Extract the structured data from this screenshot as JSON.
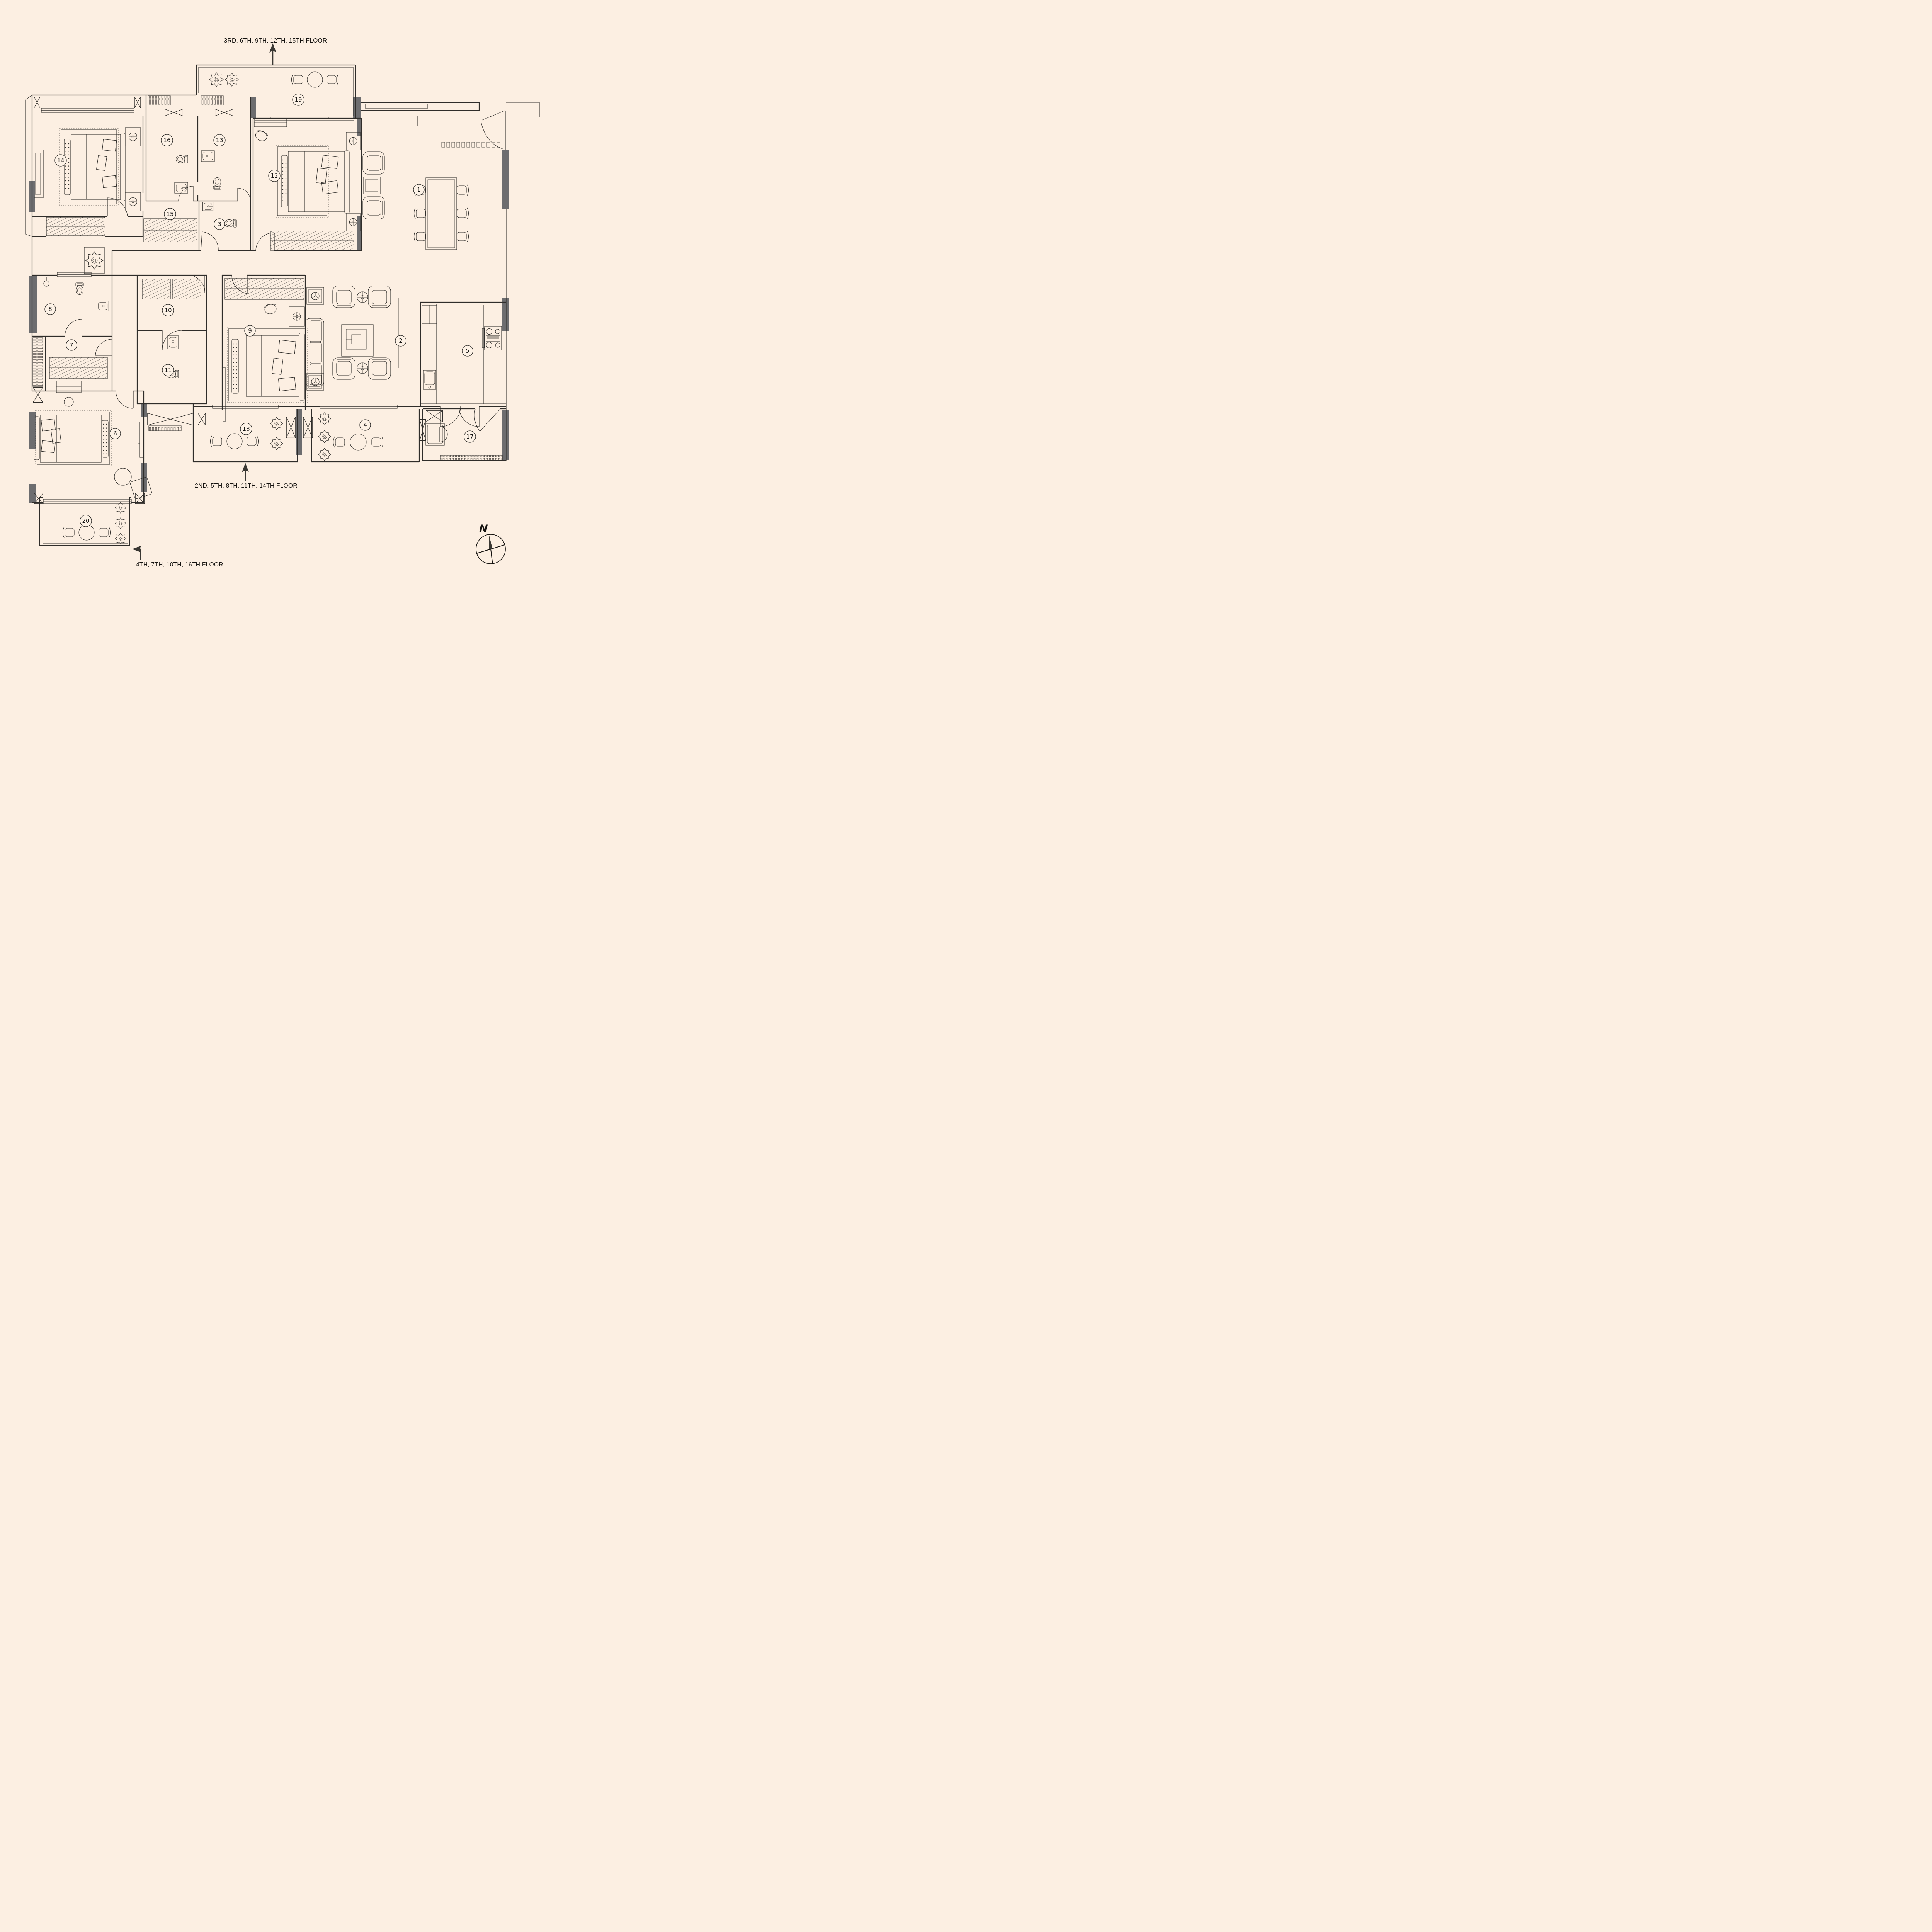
{
  "colors": {
    "background": "#fcefe2",
    "line": "#2f2d2a",
    "column_fill": "#6d6d6f"
  },
  "floor_labels": {
    "top": "3RD, 6TH, 9TH, 12TH, 15TH  FLOOR",
    "middle": "2ND, 5TH, 8TH, 11TH, 14TH  FLOOR",
    "bottom": "4TH, 7TH, 10TH, 16TH  FLOOR"
  },
  "compass": {
    "north": "N"
  },
  "rooms": {
    "r1": "1",
    "r2": "2",
    "r3": "3",
    "r4": "4",
    "r5": "5",
    "r6": "6",
    "r7": "7",
    "r8": "8",
    "r9": "9",
    "r10": "10",
    "r11": "11",
    "r12": "12",
    "r13": "13",
    "r14": "14",
    "r15": "15",
    "r16": "16",
    "r17": "17",
    "r18": "18",
    "r19": "19",
    "r20": "20"
  }
}
